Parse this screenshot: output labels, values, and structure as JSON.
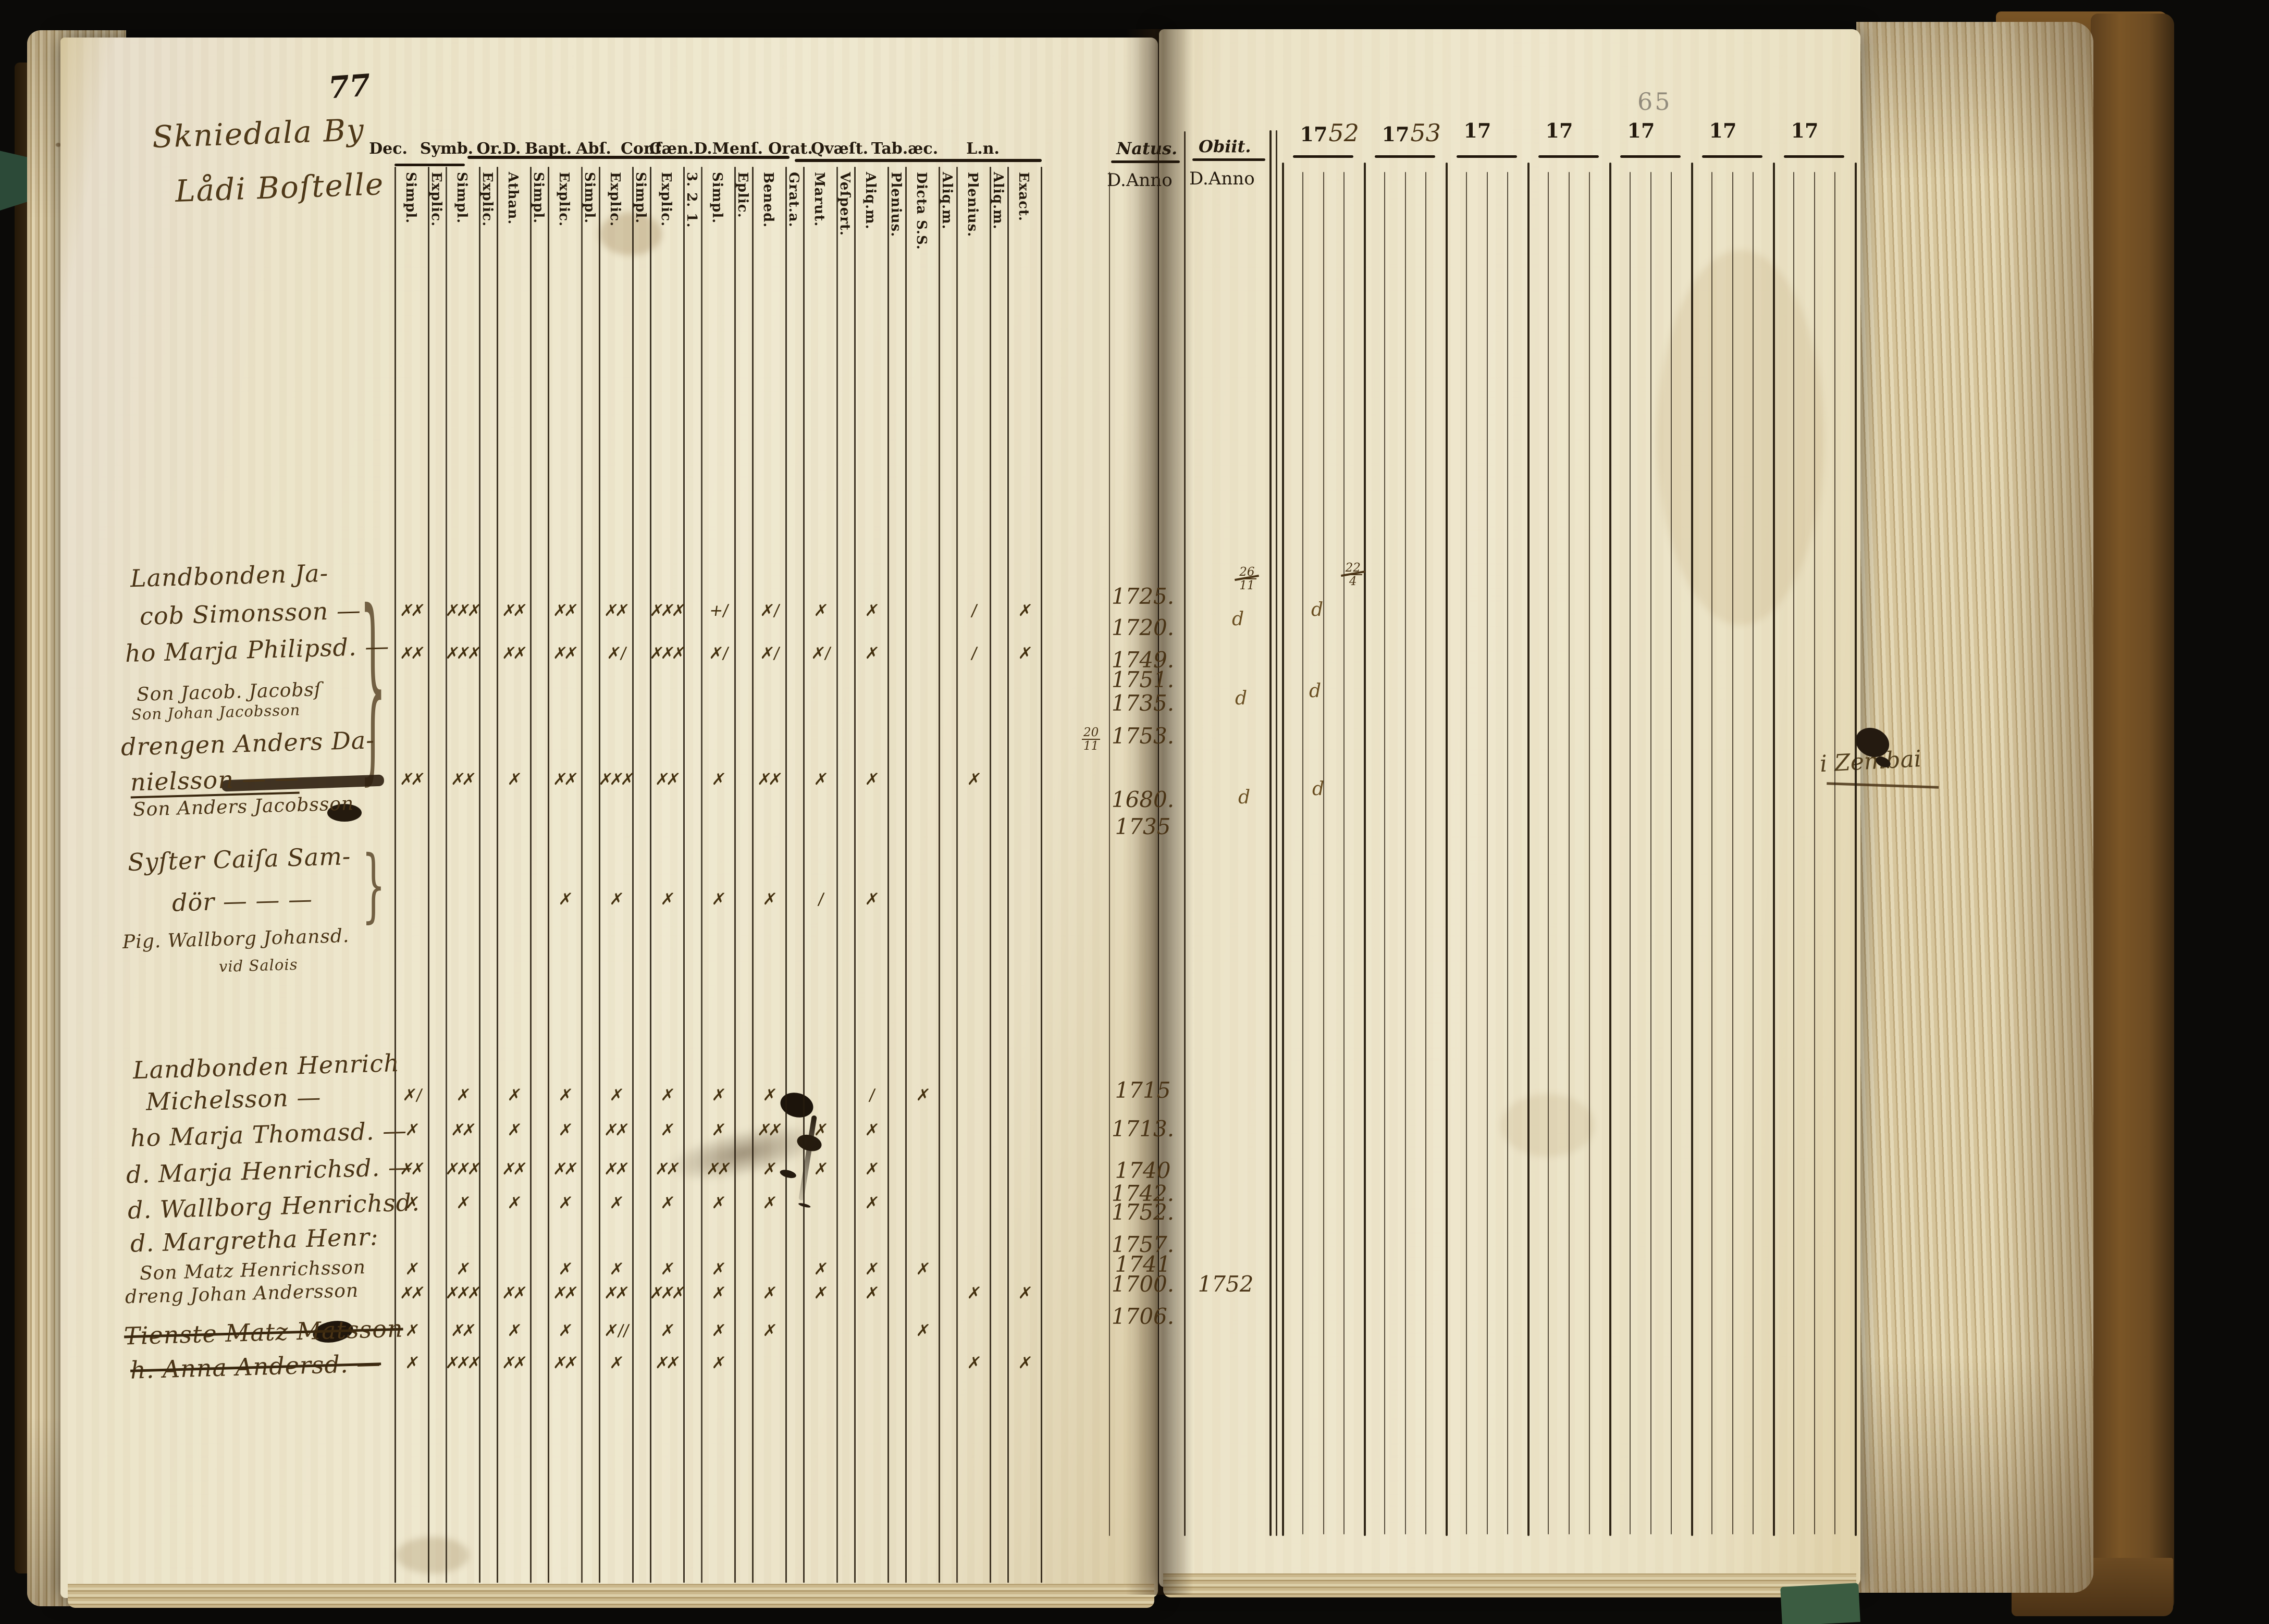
{
  "left_page": {
    "page_number": "77",
    "heading": {
      "line1": "Skniedala By",
      "line2": "Lådi Boſtelle"
    },
    "column_groups": [
      "Dec.",
      "Symb.",
      "Or.D.",
      "Bapt.",
      "Abſ.",
      "Conf.",
      "Cæn.D.Menſ.",
      "Orat.",
      "Qvæſt.",
      "Tab.æc.",
      "L.n."
    ],
    "subcolumns": [
      "Simpl.",
      "Explic.",
      "Simpl.",
      "Explic.",
      "Athan.",
      "Simpl.",
      "Explic.",
      "Simpl.",
      "Explic.",
      "Simpl.",
      "Explic.",
      "3. 2. 1.",
      "Simpl.",
      "Eplic.",
      "Bened.",
      "Grat.a.",
      "Marut.",
      "Veſpert.",
      "Aliq.m.",
      "Plenius.",
      "Dicta S.S.",
      "Aliq.m.",
      "Plenius.",
      "Aliq.m.",
      "Exact."
    ],
    "rows": [
      {
        "text": "Landbonden Ja-"
      },
      {
        "text": "cob Simonsson —"
      },
      {
        "text": "ho Marja Philipsd. —"
      },
      {
        "text": "Son Jacob. Jacobsſ",
        "small": true
      },
      {
        "text": "Son Johan Jacobsson",
        "tiny": true
      },
      {
        "text": "drengen Anders Da-"
      },
      {
        "text": "nielsson — —",
        "underline": true
      },
      {
        "text": "Son Anders Jacobsson",
        "small": true
      },
      {
        "text": "Syſter Caiſa Sam-"
      },
      {
        "text": "dör — — —"
      },
      {
        "text": "Pig. Wallborg Johansd.",
        "small": true
      },
      {
        "text": "vid Salois",
        "tiny": true
      },
      {
        "text": "Landbonden Henrich"
      },
      {
        "text": "Michelsson —"
      },
      {
        "text": "ho Marja Thomasd. —"
      },
      {
        "text": "d. Marja Henrichsd. —"
      },
      {
        "text": "d. Wallborg Henrichsd."
      },
      {
        "text": "d. Margretha Henr:"
      },
      {
        "text": "Son Matz Henrichsson",
        "small": true
      },
      {
        "text": "dreng Johan Andersson",
        "small": true
      },
      {
        "text": "Tienste Matz Matsson",
        "struck": true
      },
      {
        "text": "h. Anna Andersd. —",
        "struck": true
      }
    ],
    "mark_rows": [
      {
        "cells": [
          [
            0,
            "✗✗"
          ],
          [
            2,
            "✗✗✗"
          ],
          [
            4,
            "✗✗"
          ],
          [
            6,
            "✗✗"
          ],
          [
            8,
            "✗✗"
          ],
          [
            10,
            "✗✗✗"
          ],
          [
            12,
            "+ /"
          ],
          [
            14,
            "✗ /"
          ],
          [
            16,
            "✗"
          ],
          [
            18,
            "✗"
          ],
          [
            22,
            "/"
          ],
          [
            24,
            "✗"
          ]
        ]
      },
      {
        "cells": [
          [
            0,
            "✗✗"
          ],
          [
            2,
            "✗✗✗"
          ],
          [
            4,
            "✗✗"
          ],
          [
            6,
            "✗✗"
          ],
          [
            8,
            "✗ /"
          ],
          [
            10,
            "✗✗✗"
          ],
          [
            12,
            "✗ /"
          ],
          [
            14,
            "✗ /"
          ],
          [
            16,
            "✗ /"
          ],
          [
            18,
            "✗"
          ],
          [
            22,
            "/"
          ],
          [
            24,
            "✗"
          ]
        ]
      },
      {
        "cells": [
          [
            0,
            "✗✗"
          ],
          [
            2,
            "✗✗"
          ],
          [
            4,
            "✗"
          ],
          [
            6,
            "✗✗"
          ],
          [
            8,
            "✗✗✗"
          ],
          [
            10,
            "✗✗"
          ],
          [
            12,
            "✗"
          ],
          [
            14,
            "✗✗"
          ],
          [
            16,
            "✗"
          ],
          [
            18,
            "✗"
          ],
          [
            22,
            "✗"
          ]
        ]
      },
      {
        "cells": [
          [
            6,
            "✗"
          ],
          [
            8,
            "✗"
          ],
          [
            10,
            "✗"
          ],
          [
            12,
            "✗"
          ],
          [
            14,
            "✗"
          ],
          [
            16,
            "/"
          ],
          [
            18,
            "✗"
          ]
        ]
      },
      {
        "cells": [
          [
            0,
            "✗ /"
          ],
          [
            2,
            "✗"
          ],
          [
            4,
            "✗"
          ],
          [
            6,
            "✗"
          ],
          [
            8,
            "✗"
          ],
          [
            10,
            "✗"
          ],
          [
            12,
            "✗"
          ],
          [
            14,
            "✗"
          ],
          [
            18,
            "/"
          ],
          [
            20,
            "✗"
          ]
        ]
      },
      {
        "cells": [
          [
            0,
            "✗"
          ],
          [
            2,
            "✗✗"
          ],
          [
            4,
            "✗"
          ],
          [
            6,
            "✗"
          ],
          [
            8,
            "✗✗"
          ],
          [
            10,
            "✗"
          ],
          [
            12,
            "✗"
          ],
          [
            14,
            "✗✗"
          ],
          [
            16,
            "✗"
          ],
          [
            18,
            "✗"
          ]
        ]
      },
      {
        "cells": [
          [
            0,
            "✗✗"
          ],
          [
            2,
            "✗✗✗"
          ],
          [
            4,
            "✗✗"
          ],
          [
            6,
            "✗✗"
          ],
          [
            8,
            "✗✗"
          ],
          [
            10,
            "✗✗"
          ],
          [
            12,
            "✗✗"
          ],
          [
            14,
            "✗"
          ],
          [
            16,
            "✗"
          ],
          [
            18,
            "✗"
          ]
        ]
      },
      {
        "cells": [
          [
            0,
            "✗"
          ],
          [
            2,
            "✗"
          ],
          [
            4,
            "✗"
          ],
          [
            6,
            "✗"
          ],
          [
            8,
            "✗"
          ],
          [
            10,
            "✗"
          ],
          [
            12,
            "✗"
          ],
          [
            14,
            "✗"
          ],
          [
            18,
            "✗"
          ]
        ]
      },
      {
        "cells": [
          [
            0,
            "✗"
          ],
          [
            2,
            "✗"
          ],
          [
            6,
            "✗"
          ],
          [
            8,
            "✗"
          ],
          [
            10,
            "✗"
          ],
          [
            12,
            "✗"
          ],
          [
            16,
            "✗"
          ],
          [
            18,
            "✗"
          ],
          [
            20,
            "✗"
          ]
        ]
      },
      {
        "cells": [
          [
            0,
            "✗✗"
          ],
          [
            2,
            "✗✗✗"
          ],
          [
            4,
            "✗✗"
          ],
          [
            6,
            "✗✗"
          ],
          [
            8,
            "✗✗"
          ],
          [
            10,
            "✗✗✗"
          ],
          [
            12,
            "✗"
          ],
          [
            14,
            "✗"
          ],
          [
            16,
            "✗"
          ],
          [
            18,
            "✗"
          ],
          [
            22,
            "✗"
          ],
          [
            24,
            "✗"
          ]
        ]
      },
      {
        "cells": [
          [
            0,
            "✗"
          ],
          [
            2,
            "✗✗"
          ],
          [
            4,
            "✗"
          ],
          [
            6,
            "✗"
          ],
          [
            8,
            "✗ / /"
          ],
          [
            10,
            "✗"
          ],
          [
            12,
            "✗"
          ],
          [
            14,
            "✗"
          ],
          [
            20,
            "✗"
          ]
        ]
      },
      {
        "cells": [
          [
            0,
            "✗"
          ],
          [
            2,
            "✗✗✗"
          ],
          [
            4,
            "✗✗"
          ],
          [
            6,
            "✗✗"
          ],
          [
            8,
            "✗"
          ],
          [
            10,
            "✗✗"
          ],
          [
            12,
            "✗"
          ],
          [
            22,
            "✗"
          ],
          [
            24,
            "✗"
          ]
        ]
      }
    ]
  },
  "right_page": {
    "page_number": "65",
    "natus_label": "Natus.",
    "obiit_label": "Obiit.",
    "anno_label": "D.Anno",
    "year_labels": [
      {
        "printed": "17",
        "hand": "52"
      },
      {
        "printed": "17",
        "hand": "53"
      },
      {
        "printed": "17",
        "hand": ""
      },
      {
        "printed": "17",
        "hand": ""
      },
      {
        "printed": "17",
        "hand": ""
      },
      {
        "printed": "17",
        "hand": ""
      },
      {
        "printed": "17",
        "hand": ""
      }
    ],
    "natus_entries": [
      {
        "value": "1725."
      },
      {
        "value": "1720."
      },
      {
        "value": "1749."
      },
      {
        "value": "1751.",
        "small": true
      },
      {
        "value": "1735."
      },
      {
        "value": "1753.",
        "prefix": "20/11"
      },
      {
        "value": "1680."
      },
      {
        "value": "1735"
      },
      {
        "value": "1715"
      },
      {
        "value": "1713."
      },
      {
        "value": "1740"
      },
      {
        "value": "1742."
      },
      {
        "value": "1752."
      },
      {
        "value": "1757."
      },
      {
        "value": "1741"
      },
      {
        "value": "1700."
      },
      {
        "value": "1706."
      }
    ],
    "obiit_entries": [
      {
        "value": "1752"
      }
    ],
    "year_annotations": [
      {
        "value": "26/11",
        "struck": true
      },
      {
        "value": "22/4",
        "struck": true
      },
      {
        "value": "d"
      },
      {
        "value": "d"
      },
      {
        "value": "d"
      },
      {
        "value": "d"
      },
      {
        "value": "d"
      },
      {
        "value": "d"
      }
    ],
    "margin_note": "i Zembai"
  }
}
